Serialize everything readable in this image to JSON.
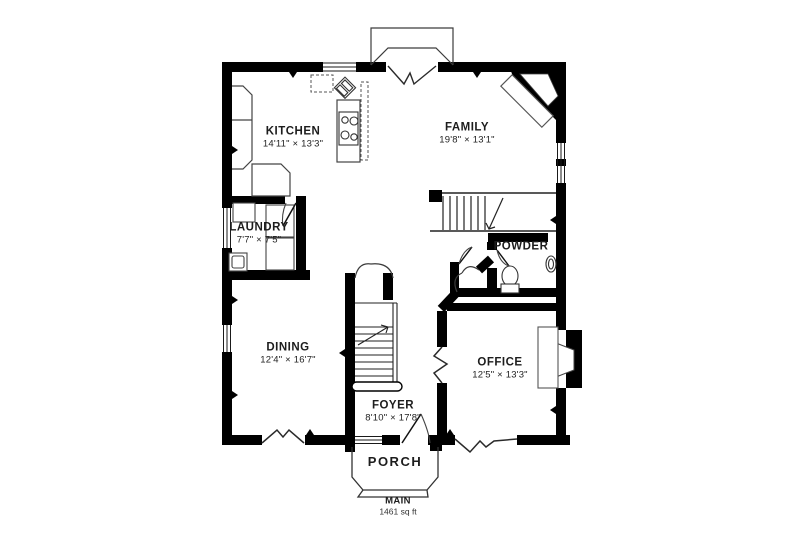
{
  "page": {
    "background": "#ffffff"
  },
  "plan": {
    "colors": {
      "wall": "#000000",
      "thin_line": "#3c3c3c",
      "text": "#1d1d1d"
    },
    "rooms": [
      {
        "id": "kitchen",
        "name": "KITCHEN",
        "dims": "14'11\" × 13'3\""
      },
      {
        "id": "family",
        "name": "FAMILY",
        "dims": "19'8\" × 13'1\""
      },
      {
        "id": "laundry",
        "name": "LAUNDRY",
        "dims": "7'7\" × 7'5\""
      },
      {
        "id": "powder",
        "name": "POWDER"
      },
      {
        "id": "dining",
        "name": "DINING",
        "dims": "12'4\" × 16'7\""
      },
      {
        "id": "office",
        "name": "OFFICE",
        "dims": "12'5\" × 13'3\""
      },
      {
        "id": "foyer",
        "name": "FOYER",
        "dims": "8'10\" × 17'8\""
      },
      {
        "id": "porch",
        "name": "PORCH"
      }
    ],
    "footer": {
      "level": "MAIN",
      "area": "1461 sq ft"
    }
  }
}
